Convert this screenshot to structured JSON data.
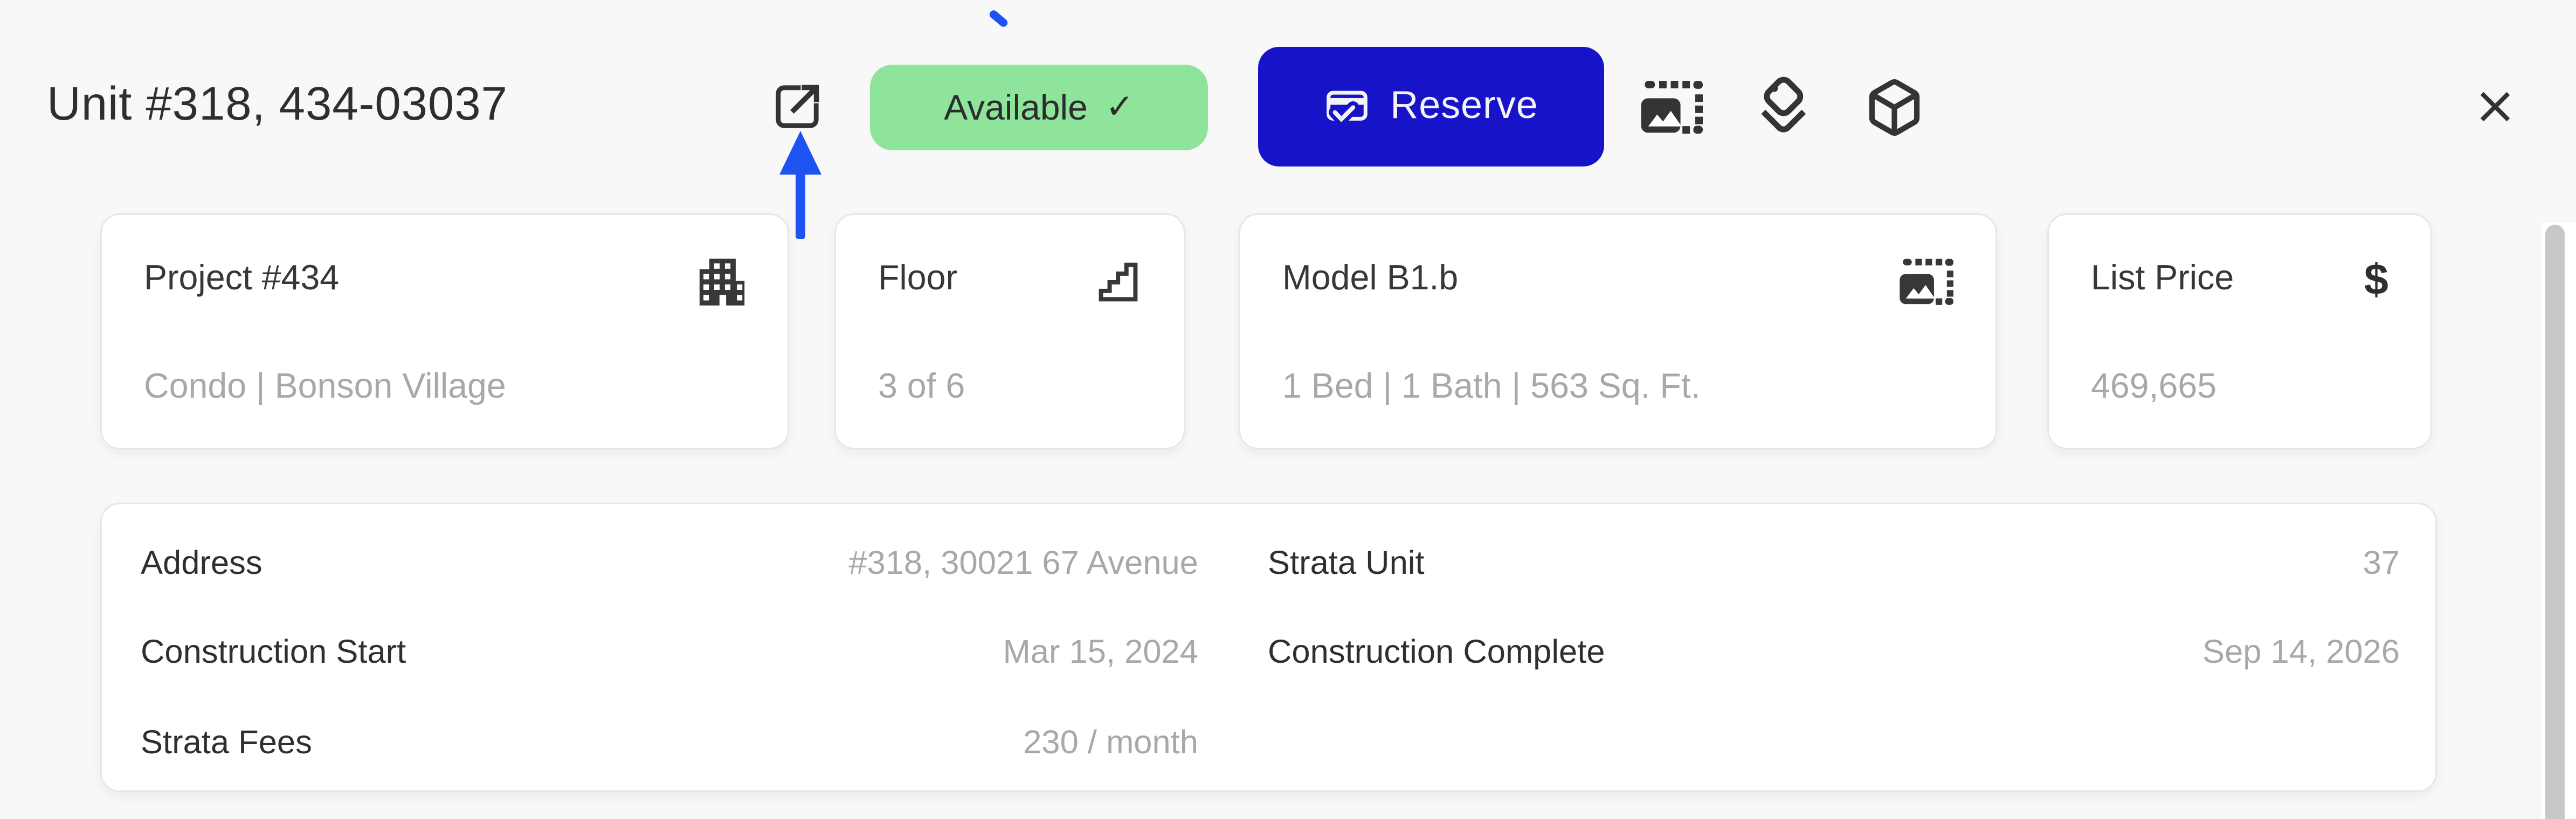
{
  "colors": {
    "page_bg": "#f8f8f8",
    "card_bg": "#ffffff",
    "primary_blue": "#1713c9",
    "badge_green": "#8fe49b",
    "annotation_blue": "#1e53f2",
    "text_dark": "#2e2e2e",
    "text_gray": "#a8a8a8",
    "scrollbar_gray": "#c8c8c8"
  },
  "header": {
    "title": "Unit #318, 434-03037",
    "external_link_icon": "external-link-icon",
    "status_badge": {
      "label": "Available",
      "check": "✓"
    },
    "reserve_button": {
      "label": "Reserve",
      "icon": "reservation-check-icon"
    },
    "toolbar_icons": [
      "media-image-icon",
      "tags-icon",
      "cube-3d-icon"
    ],
    "close_icon": "close-icon"
  },
  "summary_cards": [
    {
      "title": "Project #434",
      "subtitle": "Condo | Bonson Village",
      "icon": "building-icon"
    },
    {
      "title": "Floor",
      "subtitle": "3 of 6",
      "icon": "stairs-icon"
    },
    {
      "title": "Model B1.b",
      "subtitle": "1 Bed | 1 Bath | 563 Sq. Ft.",
      "icon": "floorplan-image-icon"
    },
    {
      "title": "List Price",
      "subtitle": "469,665",
      "icon": "dollar-icon",
      "dollar_glyph": "$"
    }
  ],
  "details": {
    "left": [
      {
        "label": "Address",
        "value": "#318, 30021 67 Avenue"
      },
      {
        "label": "Construction Start",
        "value": "Mar 15, 2024"
      },
      {
        "label": "Strata Fees",
        "value": "230 / month"
      }
    ],
    "right": [
      {
        "label": "Strata Unit",
        "value": "37"
      },
      {
        "label": "Construction Complete",
        "value": "Sep 14, 2026"
      }
    ]
  }
}
